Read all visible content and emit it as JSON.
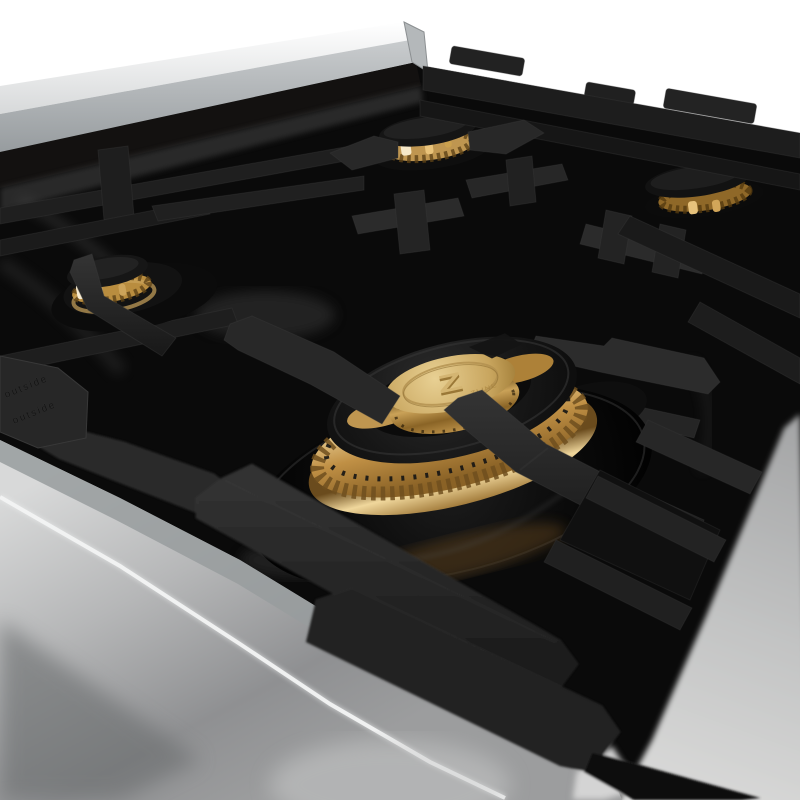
{
  "scene": {
    "type": "product-photograph",
    "subject": "Angled close-up of a gas rangetop: black porcelain cooktop, matte black cast-iron grates, brass burners, stainless steel body on white background",
    "background_color": "#ffffff"
  },
  "colors": {
    "white_bg": "#ffffff",
    "stainless_bright": "#f2f3f3",
    "stainless_mid": "#b9bcbe",
    "stainless_shadow": "#7e8183",
    "countertop_gray": "#d4d4d4",
    "porcelain_black": "#0a0a0a",
    "grate_black": "#1f1f1f",
    "grate_mid": "#282828",
    "grate_highlight": "#3f3f3f",
    "brass_light": "#ecd7a0",
    "brass": "#bf9650",
    "brass_deep": "#7d5a24",
    "cap_brass": "#d4b572"
  },
  "burner_cap": {
    "logo_text": "Z",
    "logo_caption": "ZLINE"
  },
  "grates": {
    "embossed_text": "outside",
    "embossed_text_2": "outside",
    "finish": "matte black cast iron"
  },
  "burners": [
    {
      "name": "rear-center-burner"
    },
    {
      "name": "rear-right-burner"
    },
    {
      "name": "left-middle-burner"
    },
    {
      "name": "right-middle-burner"
    },
    {
      "name": "front-center-main-burner"
    }
  ]
}
